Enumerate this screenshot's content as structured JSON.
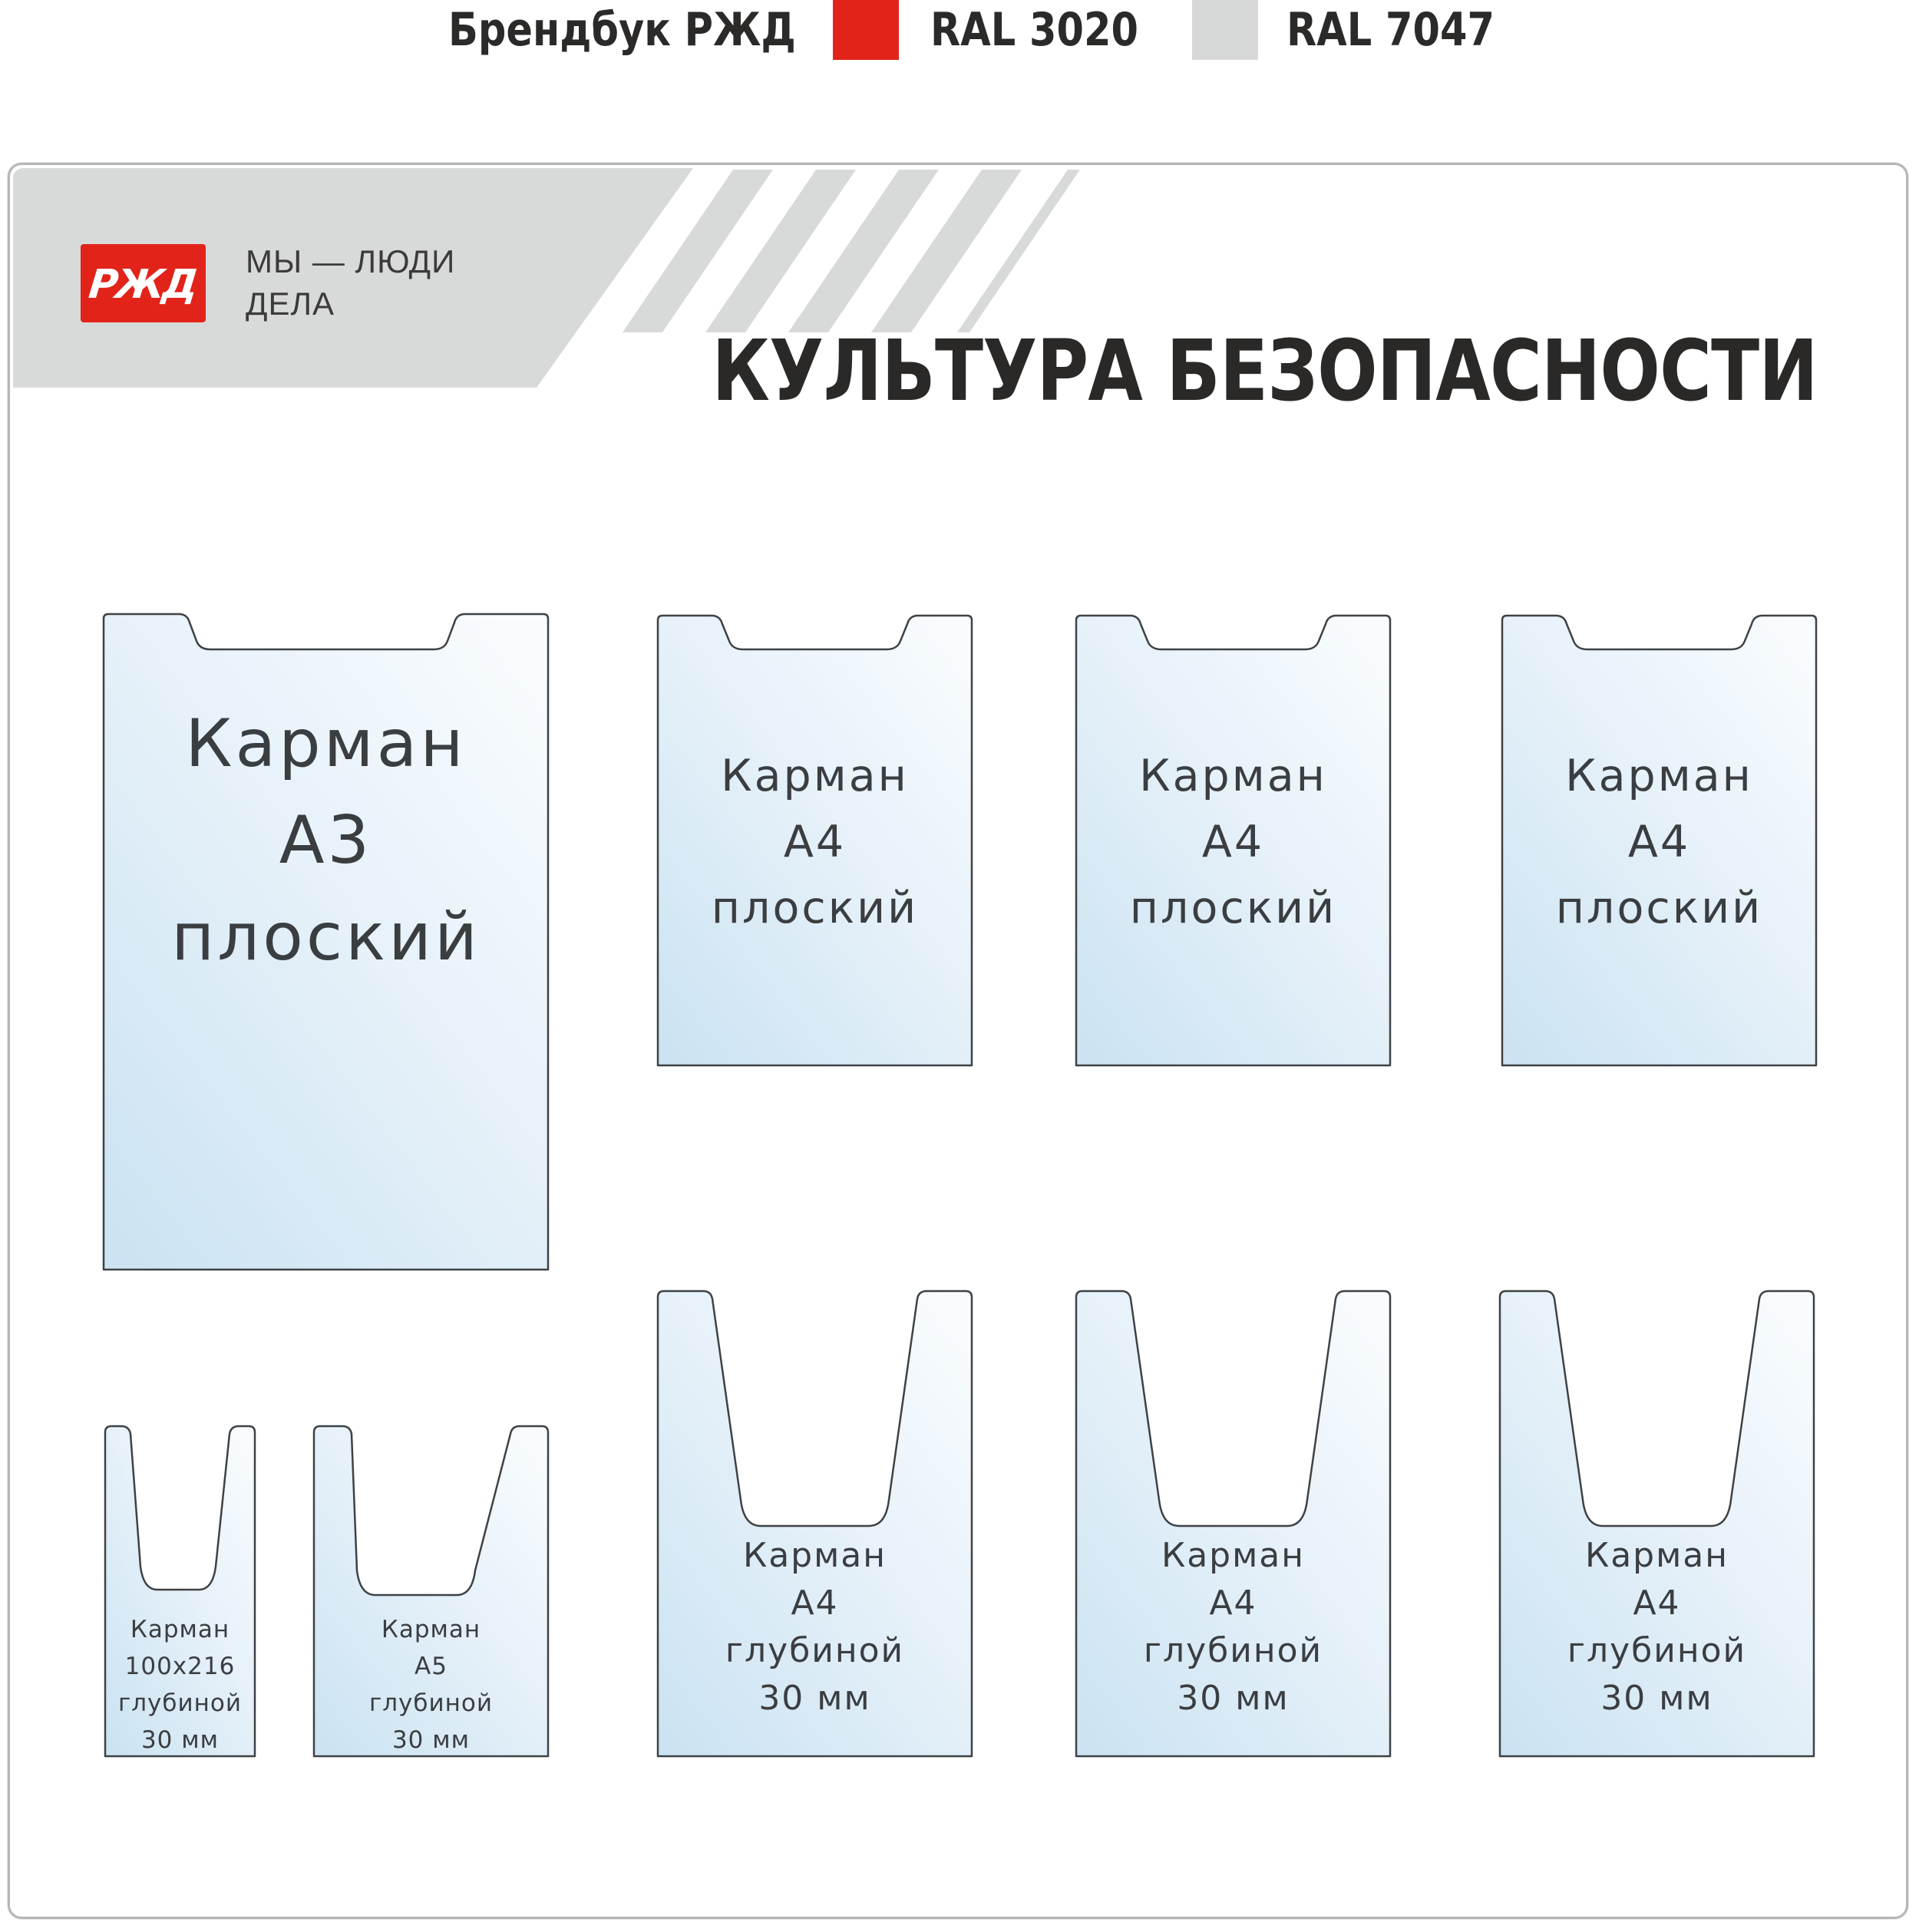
{
  "header": {
    "brandbook_label": "Брендбук РЖД",
    "swatches": [
      {
        "label": "RAL 3020",
        "color": "#e2231a"
      },
      {
        "label": "RAL 7047",
        "color": "#d6d8d7"
      }
    ]
  },
  "board": {
    "logo": {
      "text": "РЖД",
      "color": "#e2231a"
    },
    "slogan": {
      "line1": "МЫ — ЛЮДИ",
      "line2": "ДЕЛА"
    },
    "title": "КУЛЬТУРА БЕЗОПАСНОСТИ",
    "colors": {
      "band": "#d8dad9",
      "pocket_fill_light": "#f9fcfe",
      "pocket_fill_dark": "#cbe3f2",
      "pocket_stroke": "#3e4245",
      "pocket_text": "#3b3e41",
      "title_color": "#2a2928"
    },
    "pockets": [
      {
        "id": "pocket-a3-flat",
        "kind": "a3flat",
        "lines": [
          "Карман",
          "А3",
          "плоский"
        ]
      },
      {
        "id": "pocket-a4-flat-1",
        "kind": "a4flat",
        "lines": [
          "Карман",
          "А4",
          "плоский"
        ]
      },
      {
        "id": "pocket-a4-flat-2",
        "kind": "a4flat",
        "lines": [
          "Карман",
          "А4",
          "плоский"
        ]
      },
      {
        "id": "pocket-a4-flat-3",
        "kind": "a4flat",
        "lines": [
          "Карман",
          "А4",
          "плоский"
        ]
      },
      {
        "id": "pocket-100x216-deep",
        "kind": "small",
        "lines": [
          "Карман",
          "100х216",
          "глубиной",
          "30 мм"
        ]
      },
      {
        "id": "pocket-a5-deep",
        "kind": "a5",
        "lines": [
          "Карман",
          "А5",
          "глубиной",
          "30 мм"
        ]
      },
      {
        "id": "pocket-a4-deep-1",
        "kind": "a4deep",
        "lines": [
          "Карман",
          "А4",
          "глубиной",
          "30 мм"
        ]
      },
      {
        "id": "pocket-a4-deep-2",
        "kind": "a4deep",
        "lines": [
          "Карман",
          "А4",
          "глубиной",
          "30 мм"
        ]
      },
      {
        "id": "pocket-a4-deep-3",
        "kind": "a4deep",
        "lines": [
          "Карман",
          "А4",
          "глубиной",
          "30 мм"
        ]
      }
    ]
  }
}
